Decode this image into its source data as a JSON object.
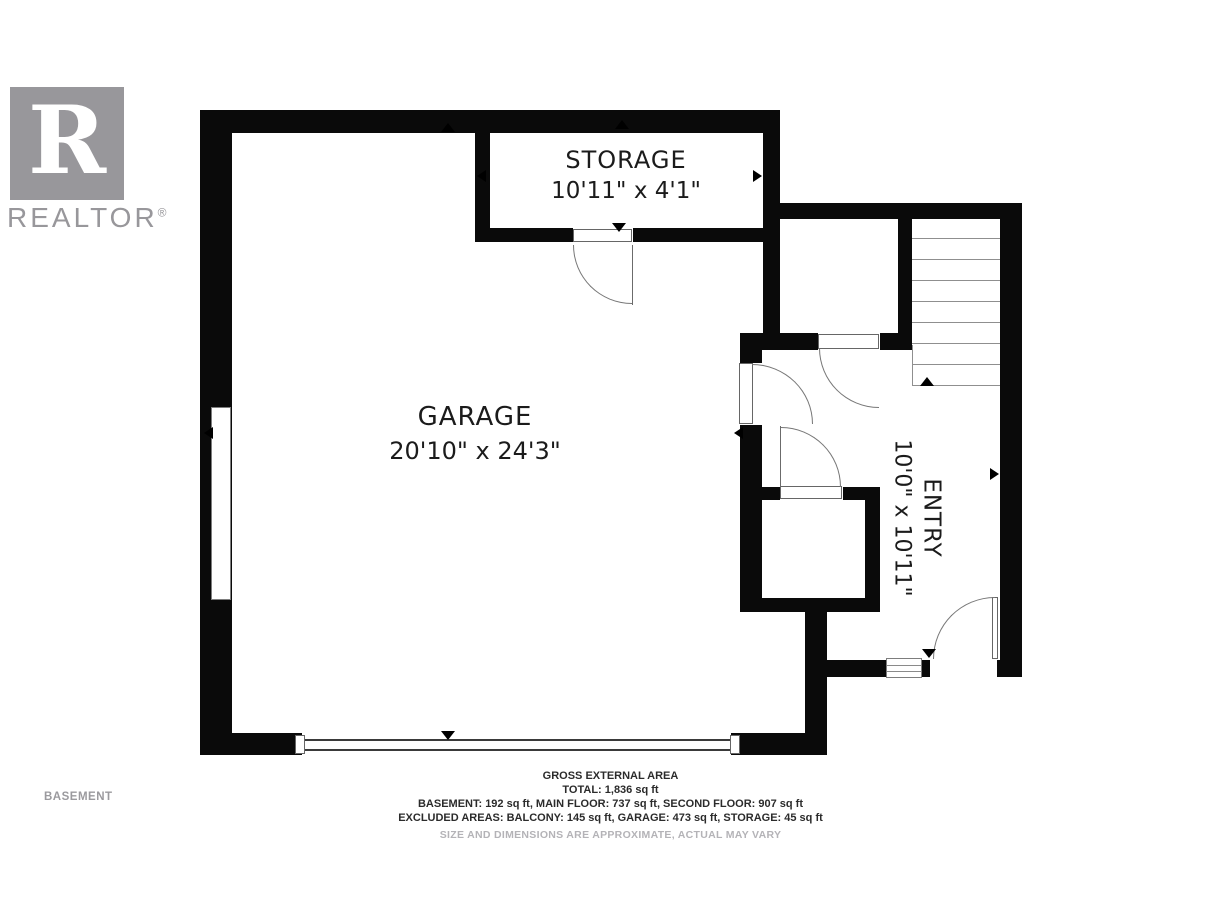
{
  "logo": {
    "r_letter": "R",
    "brand": "REALTOR",
    "registered": "®"
  },
  "floor_label": "BASEMENT",
  "rooms": {
    "storage": {
      "name": "STORAGE",
      "dimensions": "10'11\" x 4'1\""
    },
    "garage": {
      "name": "GARAGE",
      "dimensions": "20'10\" x 24'3\""
    },
    "entry": {
      "name": "ENTRY",
      "dimensions": "10'0\" x 10'11\""
    }
  },
  "footer": {
    "area_title": "GROSS EXTERNAL AREA",
    "total": "TOTAL: 1,836 sq ft",
    "floors": "BASEMENT: 192 sq ft, MAIN FLOOR: 737 sq ft, SECOND FLOOR: 907 sq ft",
    "excluded": "EXCLUDED AREAS: BALCONY: 145 sq ft, GARAGE: 473 sq ft, STORAGE: 45 sq ft",
    "disclaimer": "SIZE AND DIMENSIONS ARE APPROXIMATE, ACTUAL MAY VARY"
  },
  "colors": {
    "wall": "#0a0a0a",
    "thin_line": "#6b6b6b",
    "logo_gray": "#98979b",
    "muted_text": "#b4b3b7"
  }
}
